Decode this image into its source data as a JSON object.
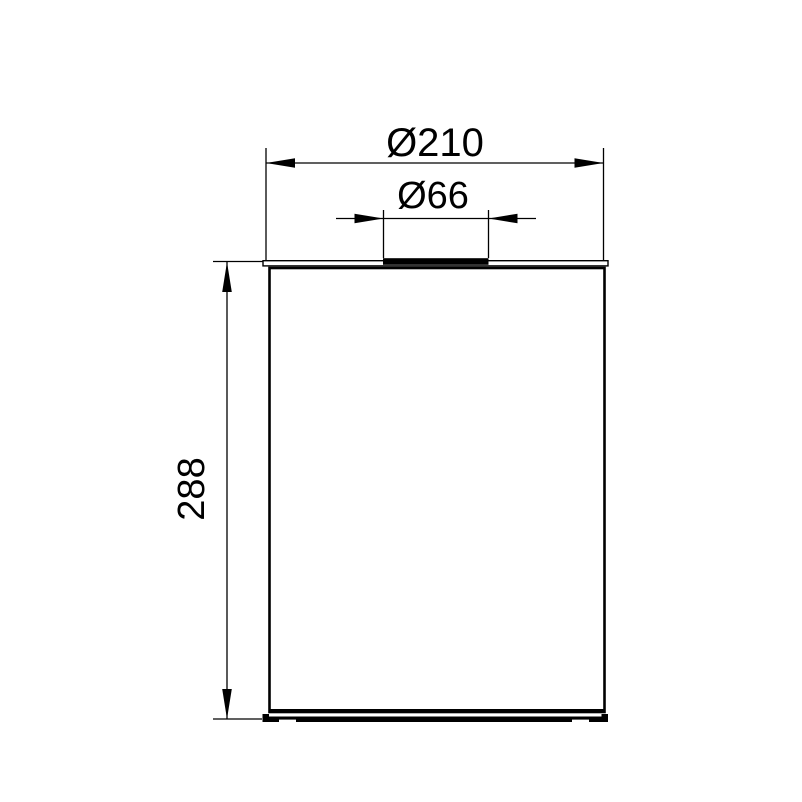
{
  "drawing": {
    "type": "technical-dimension-drawing",
    "object": "cylindrical container front view",
    "colors": {
      "line": "#000000",
      "background": "#ffffff",
      "fill": "#ffffff"
    },
    "dimensions": {
      "outer_diameter": "Ø210",
      "opening_diameter": "Ø66",
      "height": "288"
    }
  }
}
